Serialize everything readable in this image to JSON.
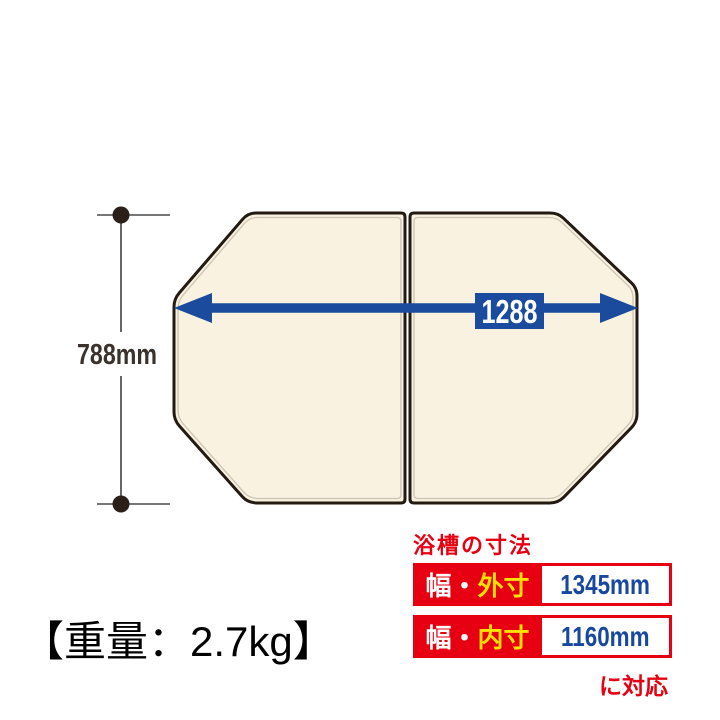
{
  "diagram": {
    "height_label": "788mm",
    "width_label": "1288"
  },
  "weight": {
    "label": "【重量：2.7kg】"
  },
  "spec": {
    "title": "浴槽の寸法",
    "rows": [
      {
        "label_prefix": "幅・",
        "label_highlight": "外寸",
        "value": "1345mm"
      },
      {
        "label_prefix": "幅・",
        "label_highlight": "内寸",
        "value": "1160mm"
      }
    ],
    "note": "に対応"
  },
  "colors": {
    "accent_red": "#e60012",
    "arrow_blue": "#1a4b9c",
    "value_blue": "#17479e",
    "highlight_yellow": "#ffe100",
    "panel_cream": "#faf2e1",
    "outline_dark": "#231a12"
  }
}
